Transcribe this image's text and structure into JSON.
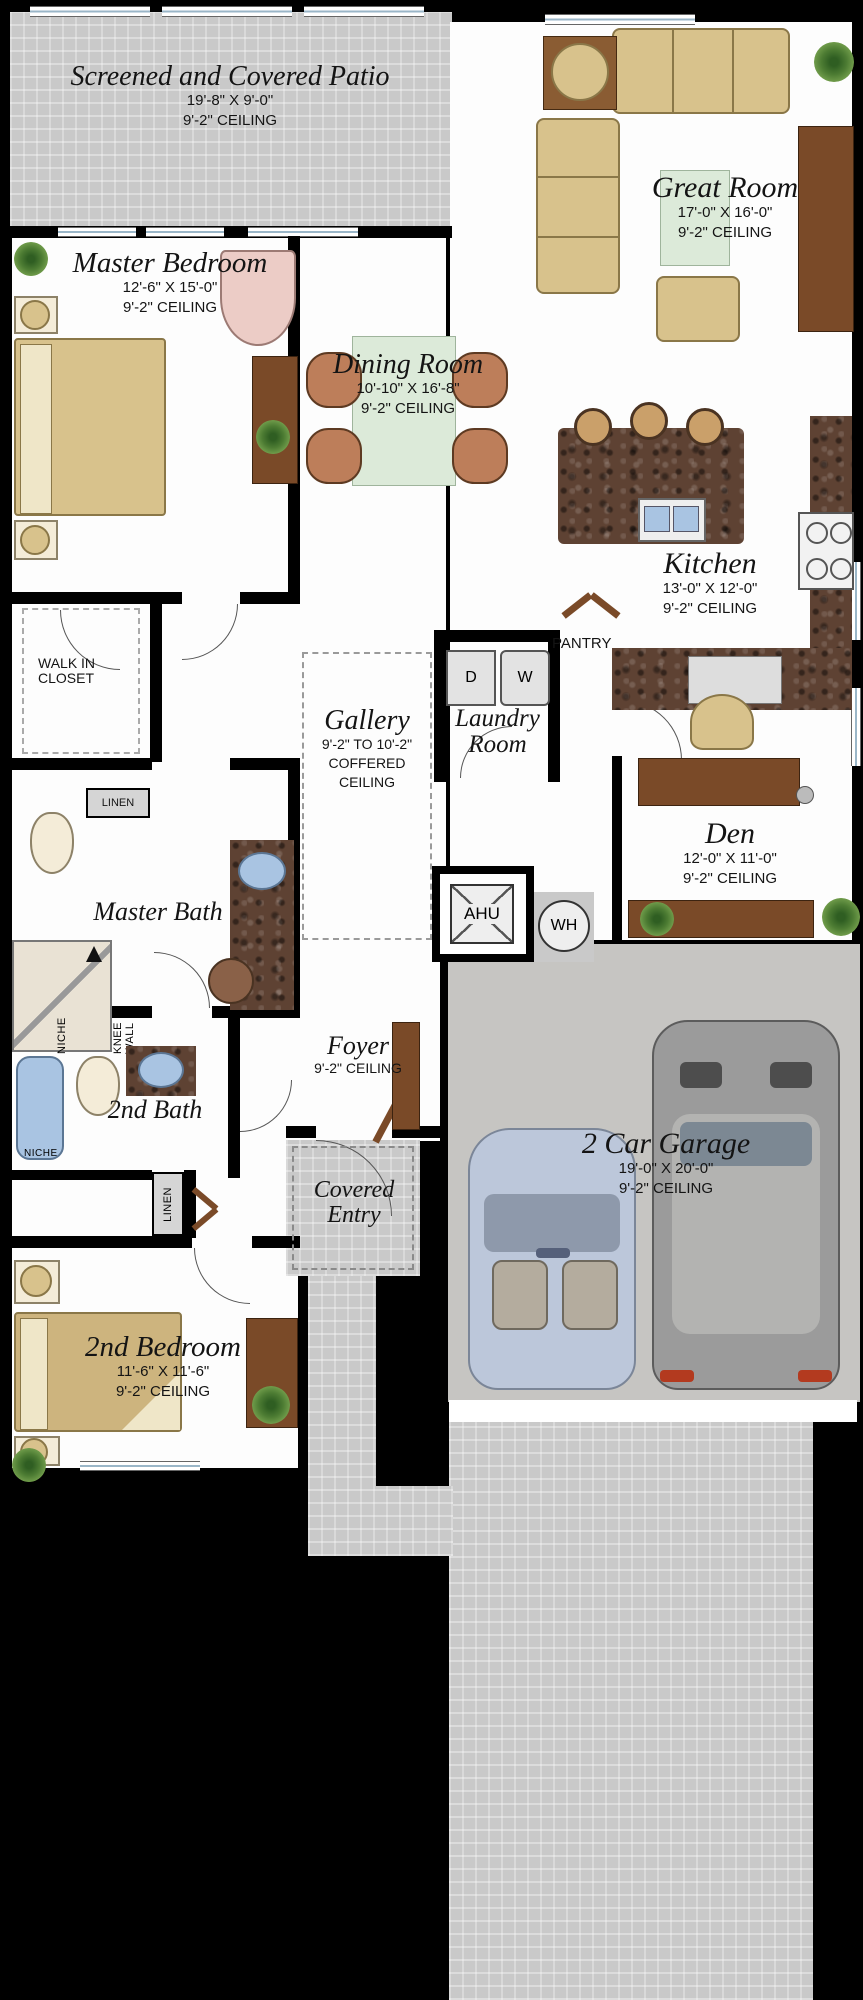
{
  "rooms": {
    "patio": {
      "name": "Screened and Covered Patio",
      "dims": "19'-8\" X 9'-0\"",
      "ceiling": "9'-2\" CEILING"
    },
    "great_room": {
      "name": "Great Room",
      "dims": "17'-0\" X 16'-0\"",
      "ceiling": "9'-2\" CEILING"
    },
    "master_bedroom": {
      "name": "Master Bedroom",
      "dims": "12'-6\" X 15'-0\"",
      "ceiling": "9'-2\" CEILING"
    },
    "dining_room": {
      "name": "Dining Room",
      "dims": "10'-10\" X 16'-8\"",
      "ceiling": "9'-2\" CEILING"
    },
    "kitchen": {
      "name": "Kitchen",
      "dims": "13'-0\" X 12'-0\"",
      "ceiling": "9'-2\" CEILING"
    },
    "laundry": {
      "name": "Laundry Room"
    },
    "gallery": {
      "name": "Gallery",
      "ceiling_range": "9'-2\" TO 10'-2\"",
      "ceiling_type_1": "COFFERED",
      "ceiling_type_2": "CEILING"
    },
    "den": {
      "name": "Den",
      "dims": "12'-0\" X 11'-0\"",
      "ceiling": "9'-2\" CEILING"
    },
    "master_bath": {
      "name": "Master Bath"
    },
    "foyer": {
      "name": "Foyer",
      "ceiling": "9'-2\" CEILING"
    },
    "second_bath": {
      "name": "2nd Bath"
    },
    "covered_entry": {
      "name": "Covered Entry"
    },
    "second_bedroom": {
      "name": "2nd Bedroom",
      "dims": "11'-6\" X 11'-6\"",
      "ceiling": "9'-2\" CEILING"
    },
    "garage": {
      "name": "2 Car Garage",
      "dims": "19'-0\" X 20'-0\"",
      "ceiling": "9'-2\" CEILING"
    },
    "walk_in_closet": {
      "name": "WALK IN CLOSET"
    },
    "pantry": {
      "name": "PANTRY"
    }
  },
  "labels": {
    "linen_master": "LINEN",
    "linen_hall": "LINEN",
    "niche_shower": "NICHE",
    "niche_tub": "NICHE",
    "knee_wall": "KNEE WALL",
    "dryer": "D",
    "washer": "W",
    "ahu": "AHU",
    "water_heater": "WH"
  },
  "colors": {
    "background": "#000000",
    "floor": "#fdfdfd",
    "concrete": "#c9c9c9",
    "garage_slab": "#c6c5c2",
    "wood": "#7a4a28",
    "tan_furniture": "#d8c28c",
    "granite": "#5e4233",
    "mint_rug": "#dcead9",
    "fixture_blue": "#a9c4e2",
    "chair_pink": "#ecccc6",
    "plant_green": "#4d7c33"
  }
}
